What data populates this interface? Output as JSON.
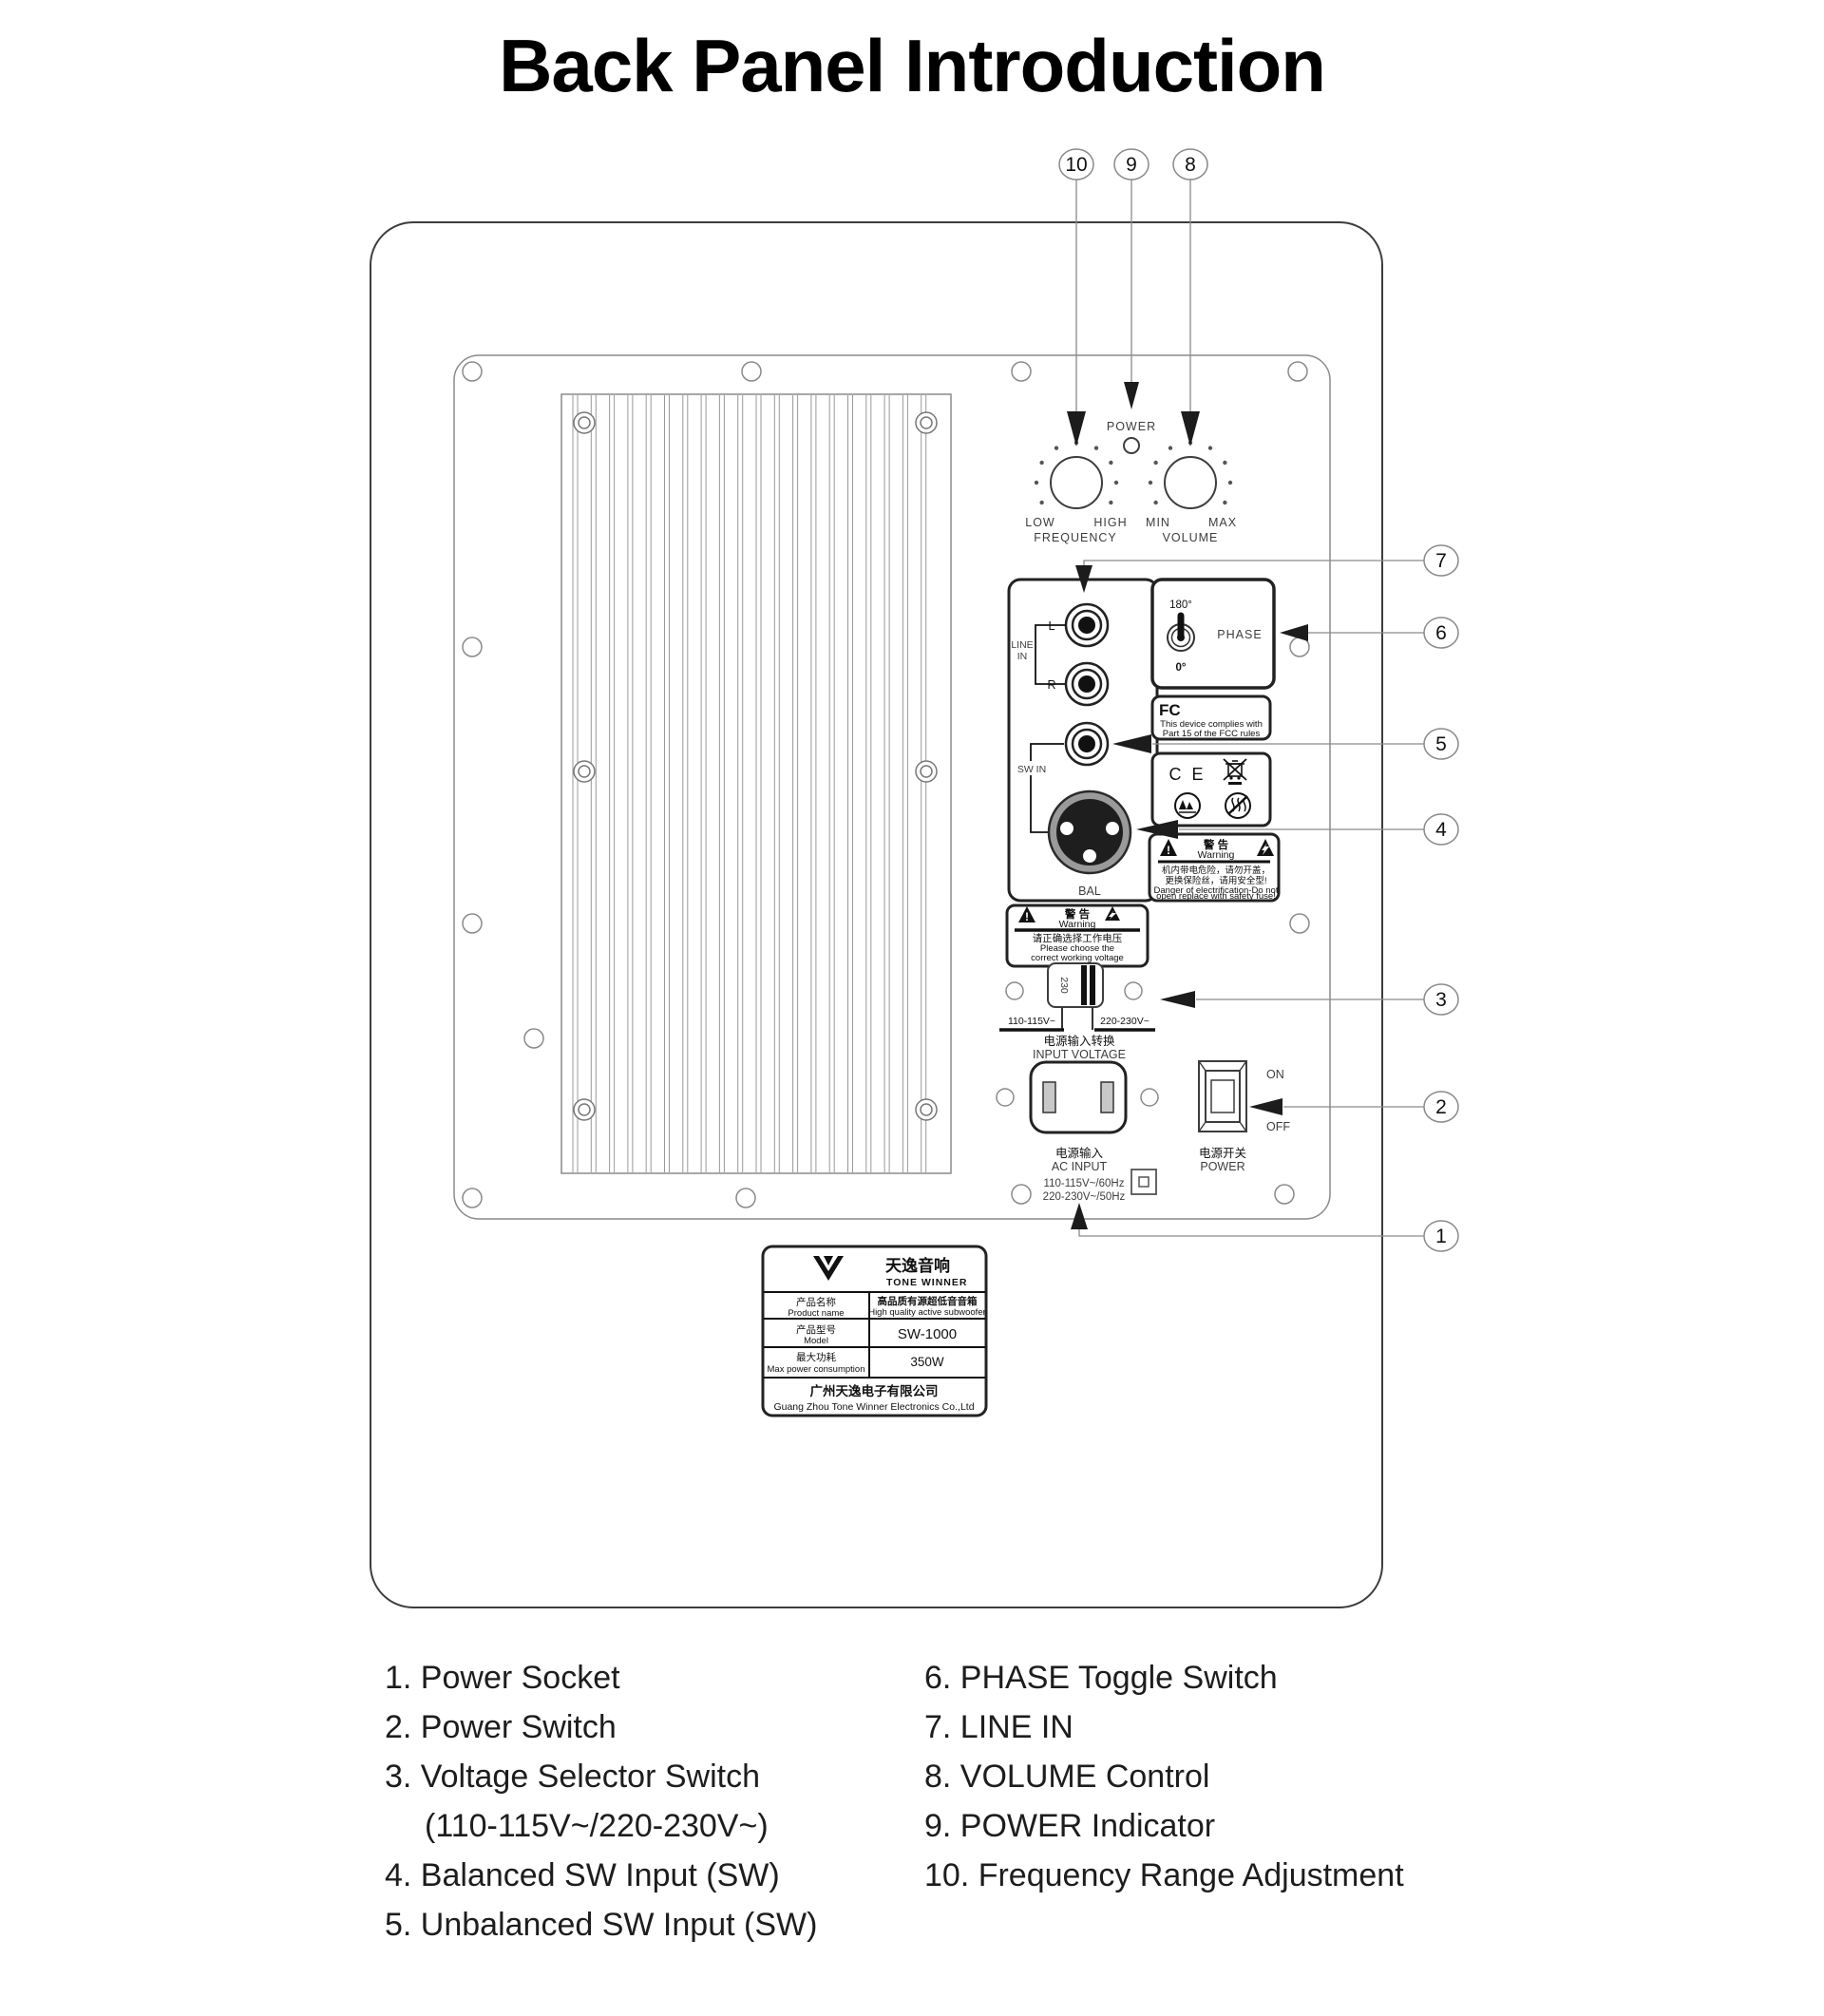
{
  "title": "Back Panel Introduction",
  "callouts": [
    "1",
    "2",
    "3",
    "4",
    "5",
    "6",
    "7",
    "8",
    "9",
    "10"
  ],
  "controls": {
    "power_led": "POWER",
    "frequency": {
      "left": "LOW",
      "right": "HIGH",
      "caption": "FREQUENCY"
    },
    "volume": {
      "left": "MIN",
      "right": "MAX",
      "caption": "VOLUME"
    }
  },
  "inputs": {
    "line_in": [
      "LINE",
      "IN"
    ],
    "left": "L",
    "right": "R",
    "sw_in": "SW IN",
    "bal": "BAL"
  },
  "phase": {
    "top": "180°",
    "bottom": "0°",
    "label": "PHASE"
  },
  "fcc": {
    "logo": "FC",
    "lines": [
      "This device complies with",
      "Part 15 of the FCC rules"
    ]
  },
  "ce": {
    "mark": "C E"
  },
  "warning_fuse": {
    "cn": "警 告",
    "en": "Warning",
    "mark": "!",
    "lines": [
      "机内带电危险，请勿开盖，",
      "更换保险丝，请用安全型!",
      "Danger of electrification-Do not",
      "open replace with safety fuse!"
    ]
  },
  "warning_voltage": {
    "cn": "警 告",
    "en": "Warning",
    "mark": "!",
    "lines": [
      "请正确选择工作电压",
      "Please choose the",
      "correct working voltage"
    ]
  },
  "voltage_selector": {
    "value": "230",
    "left": "110-115V~",
    "right": "220-230V~",
    "cn": "电源输入转换",
    "en": "INPUT VOLTAGE"
  },
  "ac_input": {
    "cn": "电源输入",
    "en": "AC INPUT",
    "lines": [
      "110-115V~/60Hz",
      "220-230V~/50Hz"
    ]
  },
  "power_switch": {
    "on": "ON",
    "off": "OFF",
    "cn": "电源开关",
    "en": "POWER"
  },
  "product_label": {
    "brand_cn": "天逸音响",
    "brand_en": "TONE WINNER",
    "rows": [
      {
        "k_cn": "产品名称",
        "k_en": "Product name",
        "v_cn": "高品质有源超低音音箱",
        "v_en": "High quality active subwoofer"
      },
      {
        "k_cn": "产品型号",
        "k_en": "Model",
        "v": "SW-1000"
      },
      {
        "k_cn": "最大功耗",
        "k_en": "Max power consumption",
        "v": "350W"
      }
    ],
    "company_cn": "广州天逸电子有限公司",
    "company_en": "Guang Zhou Tone Winner Electronics Co.,Ltd"
  },
  "legend": {
    "left": [
      "1. Power Socket",
      "2. Power Switch",
      "3. Voltage Selector Switch",
      "(110-115V~/220-230V~)",
      "4. Balanced SW Input (SW)",
      "5. Unbalanced SW Input (SW)"
    ],
    "right": [
      "6. PHASE Toggle Switch",
      "7. LINE IN",
      "8. VOLUME Control",
      "9. POWER Indicator",
      "10. Frequency Range Adjustment"
    ]
  }
}
